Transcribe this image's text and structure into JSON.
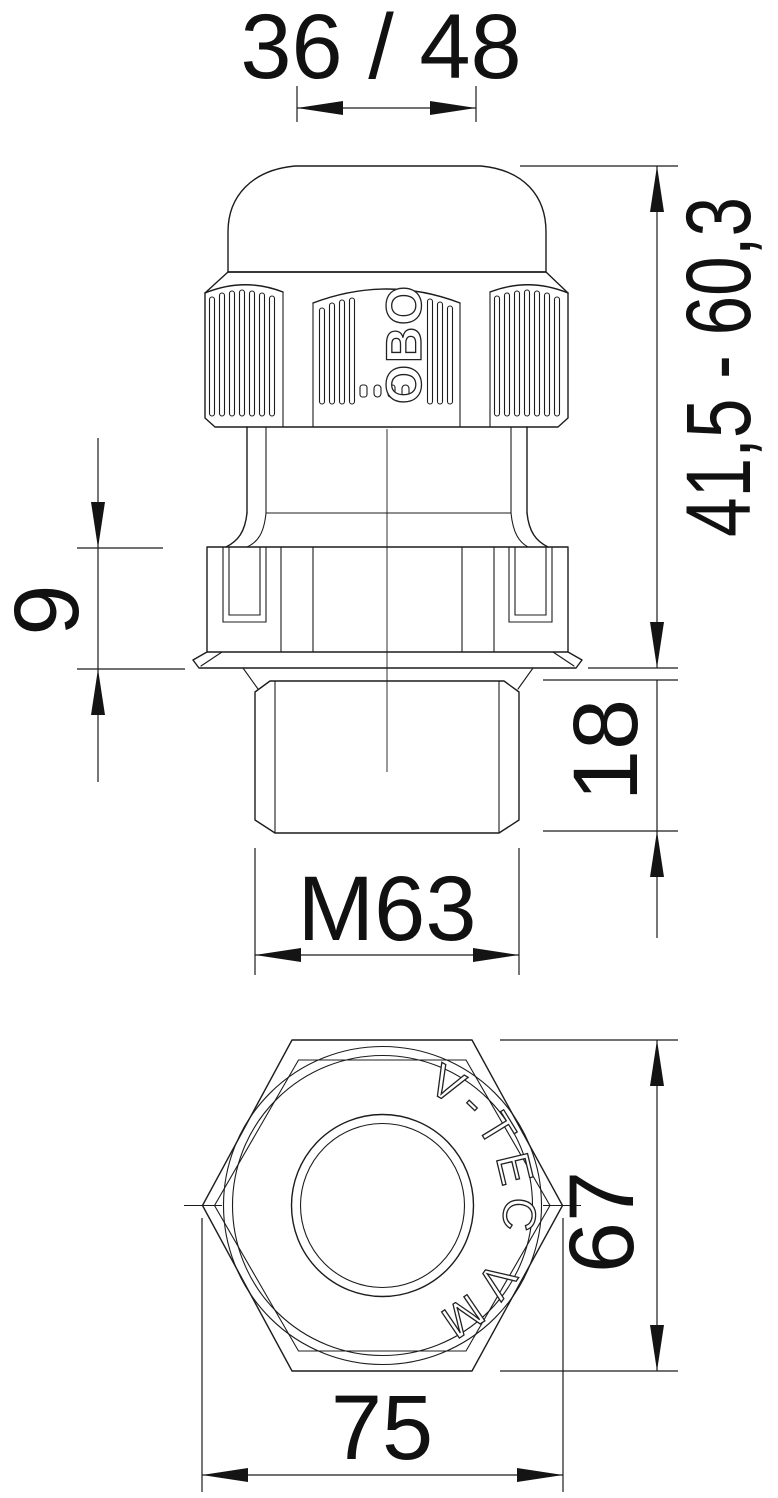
{
  "drawing": {
    "brand_logo": "OBO",
    "product_marking": "V-TEC VM",
    "labels": {
      "clamping_range": "36 / 48",
      "height_range": "41,5 - 60,3",
      "locknut_height": "9",
      "thread_length": "18",
      "thread_size": "M63",
      "across_flats": "67",
      "across_corners": "75"
    },
    "colors": {
      "ink": "#1c1c1c",
      "background": "#ffffff"
    }
  }
}
